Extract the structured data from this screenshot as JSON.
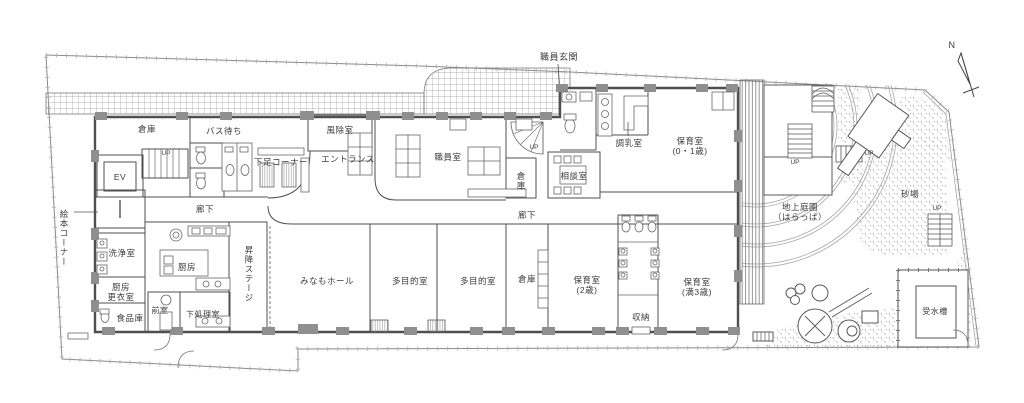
{
  "plan": {
    "compass_north": "N",
    "up_label": "UP",
    "colors": {
      "wall": "#4f4f4f",
      "wall_fill": "#8f8f8f",
      "boundary": "#8a8a8a",
      "text": "#3b3b3b"
    },
    "rooms": {
      "staff_entrance": "職員玄関",
      "storage_top_left": "倉庫",
      "bus_waiting": "バス待ち",
      "elevator": "EV",
      "picture_book_corner": "絵本コーナー",
      "corridor_west": "廊下",
      "shoe_corner": "下足コーナー",
      "windbreak_room": "風除室",
      "entrance": "エントランス",
      "staff_room": "職員室",
      "storage_center": "倉庫",
      "consultation_room": "相談室",
      "milk_prep_room": "調乳室",
      "nursery_0_1_line1": "保育室",
      "nursery_0_1_line2": "(0・1歳)",
      "corridor_center": "廊下",
      "washing_room": "洗浄室",
      "kitchen": "厨房",
      "kitchen_changing_line1": "厨房",
      "kitchen_changing_line2": "更衣室",
      "food_storage": "食品庫",
      "anteroom": "前室",
      "prep_room": "下処理室",
      "lift_stage": "昇降ステージ",
      "minamo_hall": "みなもホール",
      "multipurpose_1": "多目的室",
      "multipurpose_2": "多目的室",
      "storage_south": "倉庫",
      "nursery_2_line1": "保育室",
      "nursery_2_line2": "(2歳)",
      "nursery_3_line1": "保育室",
      "nursery_3_line2": "(満3歳)",
      "storage_closet": "収納",
      "ground_garden_line1": "地上庭園",
      "ground_garden_line2": "（はらっぱ）",
      "sandpit": "砂場",
      "water_tank": "受水槽"
    }
  }
}
